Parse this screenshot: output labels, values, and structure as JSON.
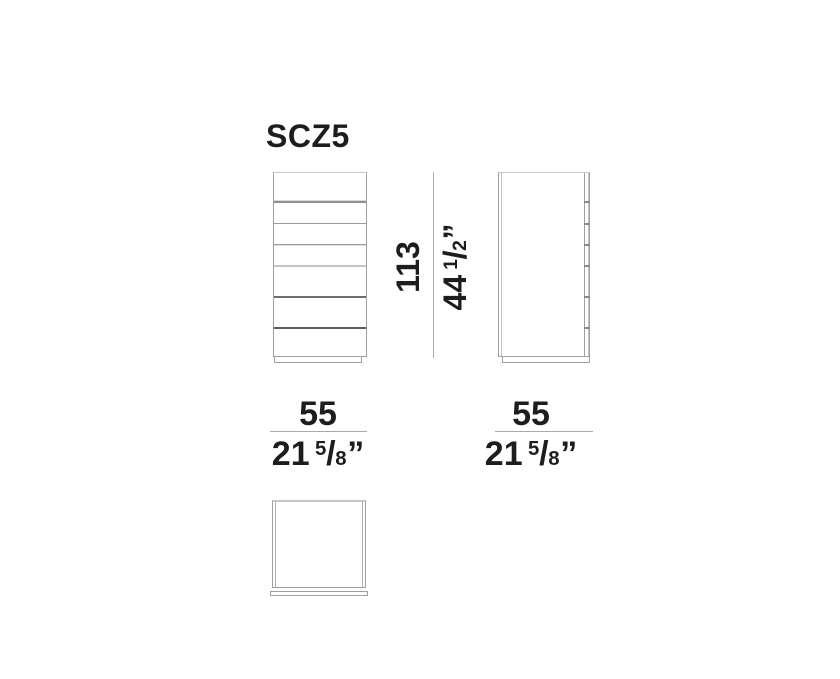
{
  "product": {
    "code": "SCZ5"
  },
  "dimensions": {
    "height": {
      "metric_cm": "113",
      "imperial_whole": "44",
      "imperial_frac_numerator": "1",
      "imperial_frac_denominator": "2",
      "unit_mark": "”"
    },
    "width": {
      "metric_cm": "55",
      "imperial_whole": "21",
      "imperial_frac_numerator": "5",
      "imperial_frac_denominator": "8",
      "unit_mark": "”"
    },
    "depth": {
      "metric_cm": "55",
      "imperial_whole": "21",
      "imperial_frac_numerator": "5",
      "imperial_frac_denominator": "8",
      "unit_mark": "”"
    }
  },
  "views": {
    "front": {
      "name": "front elevation",
      "drawer_count": 7
    },
    "side": {
      "name": "side elevation",
      "drawer_count": 7
    },
    "top": {
      "name": "top plan"
    }
  },
  "colors": {
    "text": "#1d1d1b",
    "line_gray": "#9f9f9f",
    "light_gray": "#c9c9c9",
    "dark_gray": "#5d5d5d",
    "dimension_line": "#ababab",
    "background": "#ffffff"
  }
}
